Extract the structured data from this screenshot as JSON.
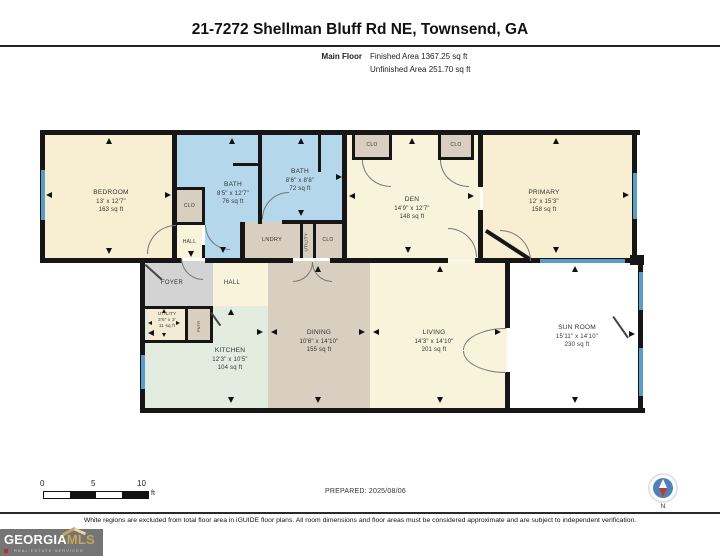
{
  "header": {
    "title": "21-7272 Shellman Bluff Rd NE, Townsend, GA",
    "floor_label": "Main Floor",
    "finished_area": "Finished Area 1367.25 sq ft",
    "unfinished_area": "Unfinished Area 251.70 sq ft"
  },
  "rooms": {
    "bedroom": {
      "name": "BEDROOM",
      "dims": "13' x 12'7\"",
      "area": "163 sq ft"
    },
    "bath1": {
      "name": "BATH",
      "dims": "8'5\" x 12'7\"",
      "area": "76 sq ft"
    },
    "bath2": {
      "name": "BATH",
      "dims": "8'6\" x 8'8\"",
      "area": "72 sq ft"
    },
    "den": {
      "name": "DEN",
      "dims": "14'9\" x 12'7\"",
      "area": "148 sq ft"
    },
    "primary": {
      "name": "PRIMARY",
      "dims": "12' x 15'3\"",
      "area": "158 sq ft"
    },
    "utility": {
      "name": "UTILITY",
      "dims": "3'6\" x 3'",
      "area": "11 sq ft"
    },
    "kitchen": {
      "name": "KITCHEN",
      "dims": "12'3\" x 10'5\"",
      "area": "104 sq ft"
    },
    "dining": {
      "name": "DINING",
      "dims": "10'6\" x 14'10\"",
      "area": "155 sq ft"
    },
    "living": {
      "name": "LIVING",
      "dims": "14'3\" x 14'10\"",
      "area": "201 sq ft"
    },
    "sunroom": {
      "name": "SUN ROOM",
      "dims": "15'11\" x 14'10\"",
      "area": "230 sq ft"
    }
  },
  "labels": {
    "clo": "CLO",
    "hall": "HALL",
    "foyer": "FOYER",
    "lndry": "LNDRY",
    "utility": "UTILITY",
    "pntr": "PNTR"
  },
  "footer": {
    "scale_0": "0",
    "scale_5": "5",
    "scale_10": "10",
    "scale_unit": "ft",
    "prepared": "PREPARED: 2025/08/06",
    "compass_north": "N",
    "disclaimer": "White regions are excluded from total floor area in iGUIDE floor plans. All room dimensions and floor areas must be considered approximate and are subject to independent verification."
  },
  "logo": {
    "name_part1": "GEORGIA",
    "name_part2": "MLS",
    "tagline": "REAL ESTATE SERVICES"
  },
  "colors": {
    "wall": "#161616",
    "window_blue": "#5b9cc9",
    "bath_blue": "#b4d7ec",
    "room_cream": "#f8efd2",
    "room_cream_light": "#faf3dc",
    "closet_tan": "#d9cfc0",
    "dining_tan": "#d8cfc1",
    "foyer_gray": "#d3d3d3",
    "kitchen_mint": "#e2eddf",
    "sunroom_white": "#ffffff",
    "logo_gray": "#757575",
    "logo_gold": "#c9a45c",
    "compass_blue": "#4f81b8",
    "compass_red": "#c03a2b"
  }
}
